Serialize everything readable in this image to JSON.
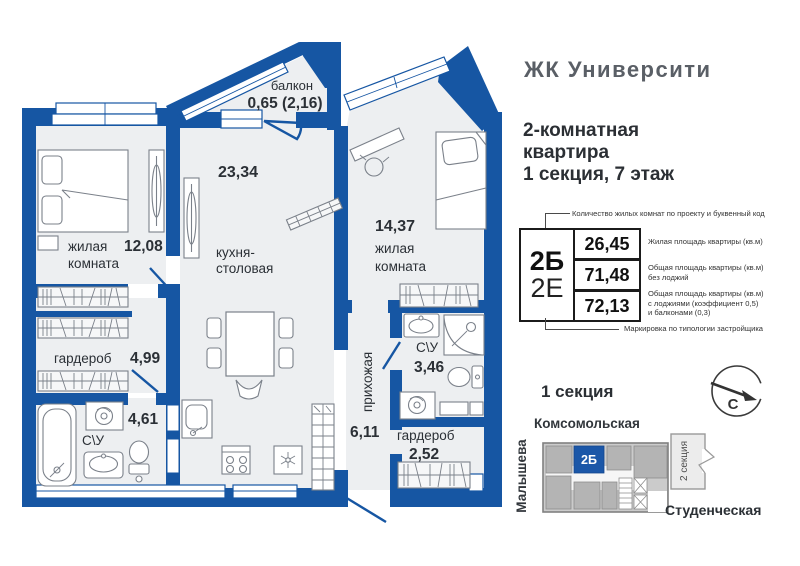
{
  "header": {
    "brand": "ЖК Университи",
    "subtitle_line1": "2-комнатная",
    "subtitle_line2": "квартира",
    "subtitle_line3": "1 секция, 7 этаж"
  },
  "info_table": {
    "top_note": "Количество жилых комнат по проекту и буквенный код",
    "bottom_note": "Маркировка по типологии застройщика",
    "code_primary": "2Б",
    "code_secondary": "2Е",
    "rows": [
      {
        "value": "26,45",
        "label_lines": [
          "Жилая площадь квартиры (кв.м)",
          "",
          ""
        ]
      },
      {
        "value": "71,48",
        "label_lines": [
          "Общая площадь квартиры (кв.м)",
          "без лоджий",
          ""
        ]
      },
      {
        "value": "72,13",
        "label_lines": [
          "Общая площадь квартиры (кв.м)",
          "с лоджиями (коэффициент 0,5)",
          "и балконами (0,3)"
        ]
      }
    ]
  },
  "plan": {
    "rooms": {
      "balcony": {
        "name": "балкон",
        "area": "0,65 (2,16)"
      },
      "bedroom_left": {
        "name_line1": "жилая",
        "name_line2": "комната",
        "area": "12,08"
      },
      "kitchen": {
        "name_line1": "кухня-",
        "name_line2": "столовая",
        "area": "23,34"
      },
      "bedroom_right": {
        "name_line1": "жилая",
        "name_line2": "комната",
        "area": "14,37"
      },
      "wardrobe_left": {
        "name": "гардероб",
        "area": "4,99"
      },
      "bathroom_left": {
        "name": "С\\У",
        "area": "4,61"
      },
      "hallway": {
        "name": "прихожая",
        "area": "6,11"
      },
      "bathroom_right": {
        "name": "С\\У",
        "area": "3,46"
      },
      "wardrobe_right": {
        "name": "гардероб",
        "area": "2,52"
      }
    }
  },
  "section_map": {
    "title": "1 секция",
    "street_top": "Комсомольская",
    "street_left": "Малышева",
    "street_bottom": "Студенческая",
    "adjacent_section": "2 секция",
    "unit_label": "2Б",
    "compass_letter": "С"
  },
  "colors": {
    "wall_blue": "#1656a3",
    "unit_highlight": "#1b57a8",
    "floor": "#edeff1"
  }
}
